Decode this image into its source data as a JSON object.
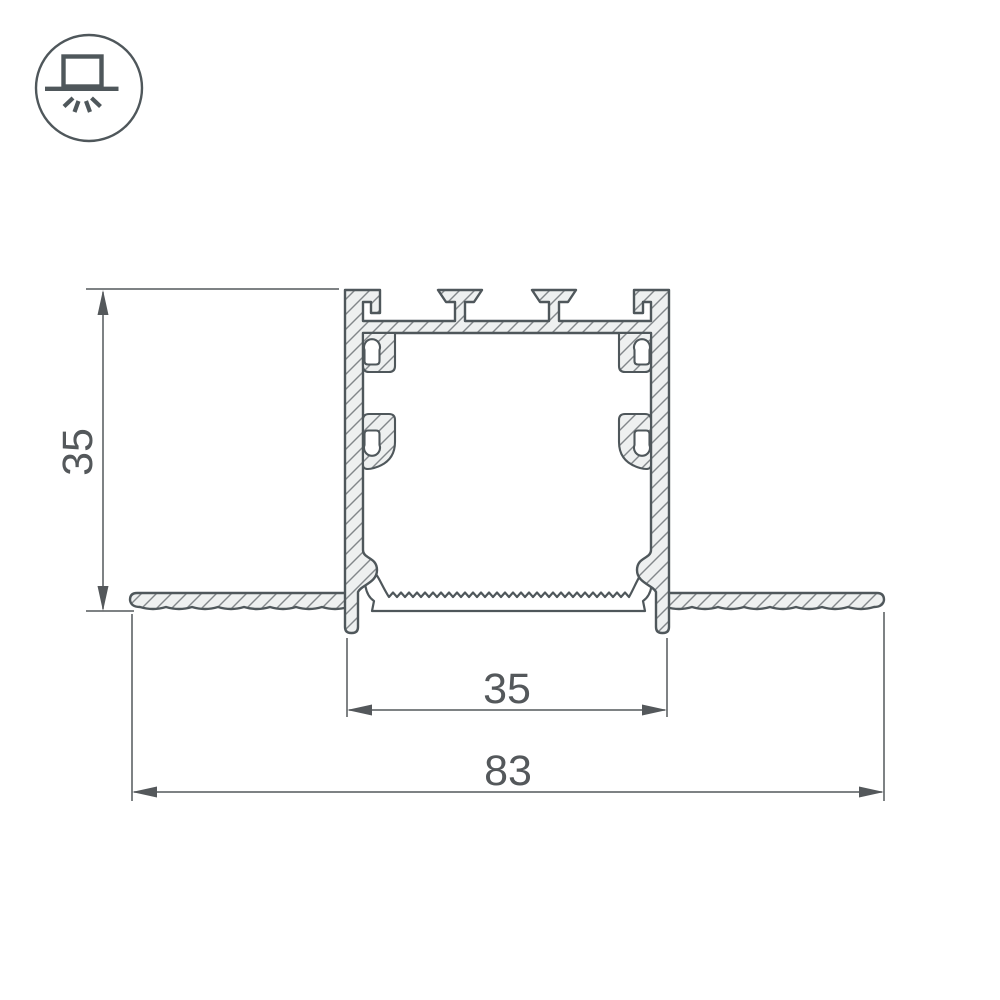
{
  "icon": {
    "name": "recessed-downlight-icon"
  },
  "drawing": {
    "dimensions": {
      "height": "35",
      "body_width": "35",
      "overall_width": "83"
    }
  },
  "colors": {
    "outline": "#4f575b",
    "dimension": "#54585b",
    "hatch_fill": "#eef0f0",
    "hatch_line": "#82878a",
    "cavity_fill": "#ffffff",
    "background": "#ffffff"
  }
}
